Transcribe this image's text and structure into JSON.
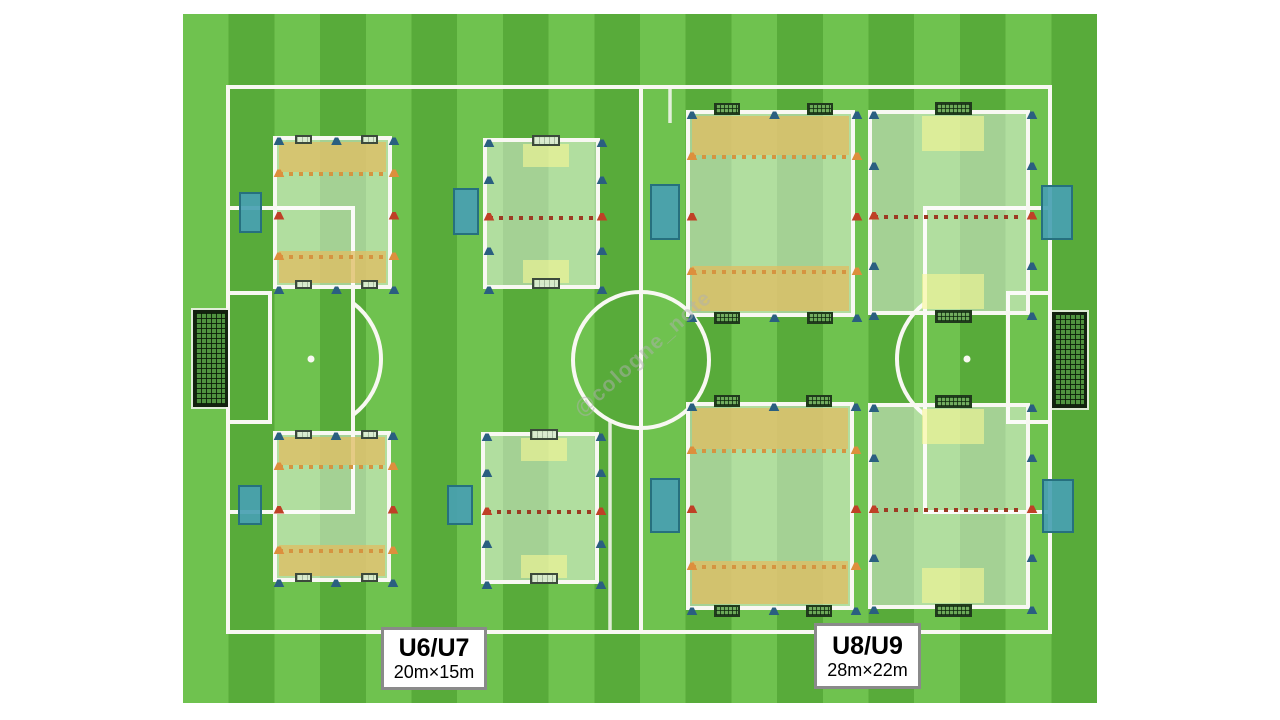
{
  "diagram": {
    "watermark": "@cologne_note",
    "labels": [
      {
        "title": "U6/U7",
        "size": "20m×15m"
      },
      {
        "title": "U8/U9",
        "size": "28m×22m"
      }
    ]
  },
  "colors": {
    "stripe_light": "#6fc24f",
    "stripe_dark": "#58ab3a",
    "line": "#f8f8f2",
    "endzone_tan": "rgba(223,190,100,0.78)",
    "overlay": "rgba(255,255,255,0.46)",
    "goalzone_yellow": "rgba(248,246,150,0.6)",
    "teal_fill": "rgba(72,160,178,0.92)",
    "teal_border": "#26707e",
    "cone_blue": "#2a5f80",
    "cone_orange": "#dd8f3d",
    "cone_red": "#bf4026",
    "dots_orange": "#d59440",
    "dots_red": "#9c3a22",
    "goal_plain_fill": "rgba(216,234,206,0.92)",
    "goal_plain_border": "#3c4a3c",
    "goal_net_fill": "rgba(108,168,88,0.95)",
    "goal_net_line": "rgba(12,38,12,0.75)",
    "goal_net_border": "#203a1c",
    "big_goal_fill": "#4f923f",
    "label_border": "#8a8a8a",
    "watermark_color": "rgba(175,175,175,0.5)"
  },
  "layout_data": {
    "mini_fields": [
      {
        "name": "u6u7-endzone-field-upper",
        "type": "endzone",
        "x": 275,
        "y": 138,
        "w": 115,
        "h": 149,
        "zt": 32,
        "zb": 34,
        "goalStyle": "plain",
        "gw": 17,
        "gh": 9,
        "goalCenters": [
          24,
          90
        ]
      },
      {
        "name": "u6u7-endzone-field-lower",
        "type": "endzone",
        "x": 275,
        "y": 433,
        "w": 114,
        "h": 147,
        "zt": 30,
        "zb": 33,
        "goalStyle": "plain",
        "gw": 17,
        "gh": 9,
        "goalCenters": [
          24,
          90
        ]
      },
      {
        "name": "u6u7-midline-field-upper",
        "type": "midline",
        "x": 485,
        "y": 140,
        "w": 113,
        "h": 147,
        "goalStyle": "plain",
        "gw": 28,
        "gh": 11,
        "zw": 46,
        "zh": 23,
        "sb": [
          37,
          108
        ]
      },
      {
        "name": "u6u7-midline-field-lower",
        "type": "midline",
        "x": 483,
        "y": 434,
        "w": 114,
        "h": 148,
        "goalStyle": "plain",
        "gw": 28,
        "gh": 11,
        "zw": 46,
        "zh": 23,
        "sb": [
          36,
          107
        ]
      },
      {
        "name": "u8u9-endzone-field-upper",
        "type": "endzone",
        "x": 688,
        "y": 112,
        "w": 165,
        "h": 203,
        "zt": 41,
        "zb": 47,
        "goalStyle": "net",
        "gw": 26,
        "gh": 12,
        "goalCenters": [
          35,
          128
        ]
      },
      {
        "name": "u8u9-endzone-field-lower",
        "type": "endzone",
        "x": 688,
        "y": 404,
        "w": 164,
        "h": 204,
        "zt": 43,
        "zb": 45,
        "goalStyle": "net",
        "gw": 26,
        "gh": 12,
        "goalCenters": [
          35,
          127
        ]
      },
      {
        "name": "u8u9-midline-field-upper",
        "type": "midline",
        "x": 870,
        "y": 112,
        "w": 158,
        "h": 201,
        "goalStyle": "net",
        "gw": 37,
        "gh": 13,
        "zw": 62,
        "zh": 35,
        "sb": [
          51,
          151
        ]
      },
      {
        "name": "u8u9-midline-field-lower",
        "type": "midline",
        "x": 870,
        "y": 405,
        "w": 158,
        "h": 202,
        "goalStyle": "net",
        "gw": 37,
        "gh": 13,
        "zw": 62,
        "zh": 35,
        "sb": [
          50,
          150
        ]
      }
    ],
    "teal_goal_boxes": [
      {
        "x": 239,
        "y": 192,
        "w": 23,
        "h": 41
      },
      {
        "x": 453,
        "y": 188,
        "w": 26,
        "h": 47
      },
      {
        "x": 650,
        "y": 184,
        "w": 30,
        "h": 56
      },
      {
        "x": 1041,
        "y": 185,
        "w": 32,
        "h": 55
      },
      {
        "x": 238,
        "y": 485,
        "w": 24,
        "h": 40
      },
      {
        "x": 447,
        "y": 485,
        "w": 26,
        "h": 40
      },
      {
        "x": 650,
        "y": 478,
        "w": 30,
        "h": 55
      },
      {
        "x": 1042,
        "y": 479,
        "w": 32,
        "h": 54
      }
    ],
    "big_goals": [
      {
        "x": 193,
        "y": 310,
        "w": 35,
        "h": 97
      },
      {
        "x": 1052,
        "y": 312,
        "w": 35,
        "h": 96
      }
    ]
  }
}
